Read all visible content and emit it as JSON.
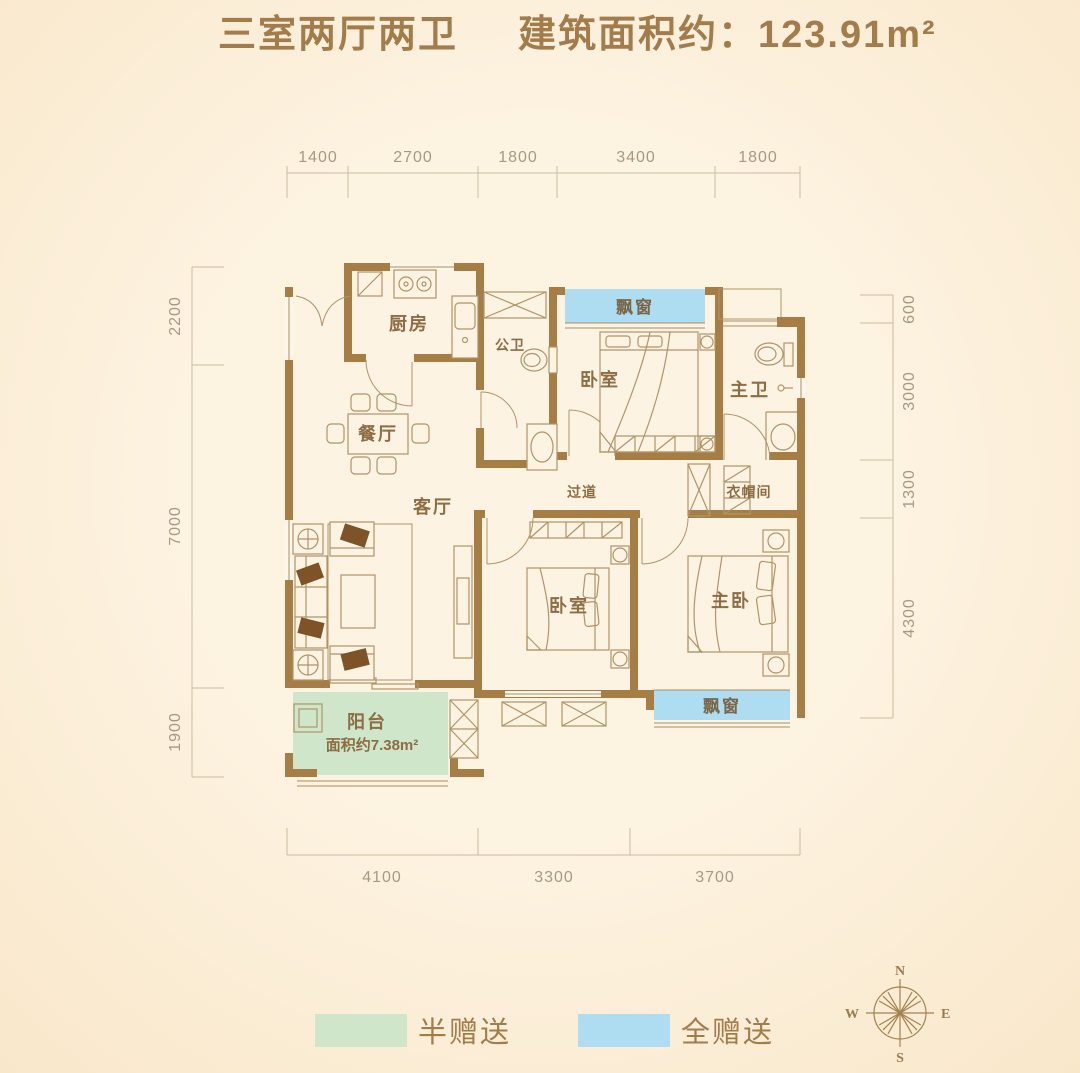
{
  "title": {
    "part1": "三室两厅两卫",
    "part2": "建筑面积约：123.91m²"
  },
  "rooms": {
    "kitchen": "厨房",
    "guest_bath": "公卫",
    "bedroom_top": "卧室",
    "master_bath": "主卫",
    "dining": "餐厅",
    "hallway": "过道",
    "cloakroom": "衣帽间",
    "living": "客厅",
    "bedroom_mid": "卧室",
    "master_bedroom": "主卧",
    "balcony": "阳台",
    "balcony_area": "面积约7.38m²",
    "bay_window_top": "飘窗",
    "bay_window_bottom": "飘窗"
  },
  "dimensions": {
    "top": [
      "1400",
      "2700",
      "1800",
      "3400",
      "1800"
    ],
    "bottom": [
      "4100",
      "3300",
      "3700"
    ],
    "left": [
      "2200",
      "7000",
      "1900"
    ],
    "right": [
      "600",
      "3000",
      "1300",
      "4300"
    ]
  },
  "legend": {
    "half": {
      "label": "半赠送",
      "color": "#cfe6cb"
    },
    "full": {
      "label": "全赠送",
      "color": "#aeddf1"
    }
  },
  "compass": {
    "n": "N",
    "s": "S",
    "e": "E",
    "w": "W"
  },
  "colors": {
    "wall": "#a67d45",
    "accent_text": "#a37c4c",
    "bay_window": "#aeddf1",
    "balcony": "#cfe6cb"
  }
}
